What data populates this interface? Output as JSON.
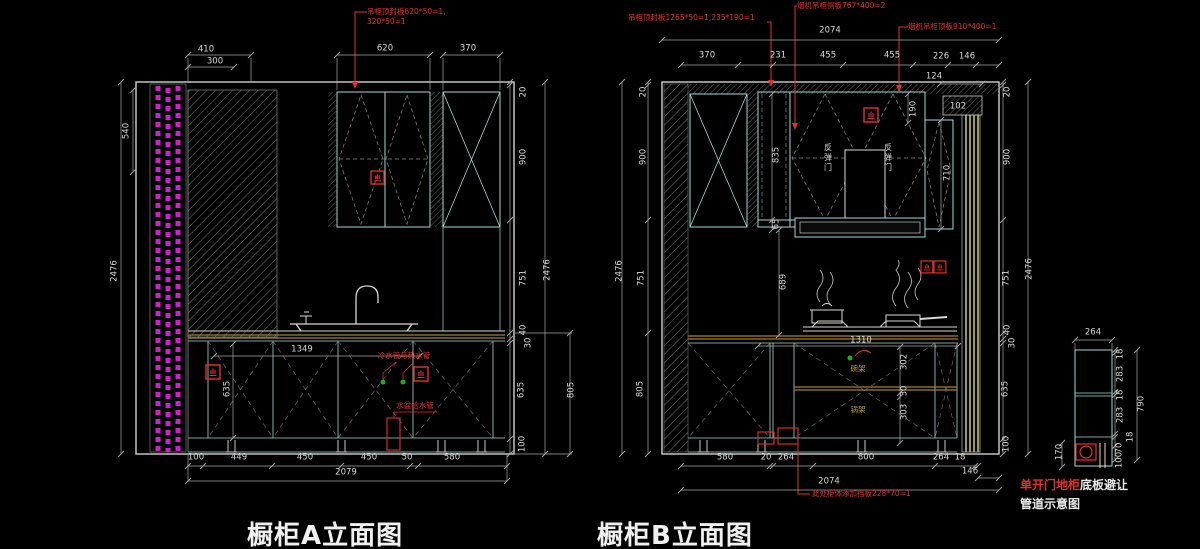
{
  "palette": {
    "background": "#000000",
    "line_white": "#e0e0e0",
    "line_cyan": "#9fd8d8",
    "annotation_red": "#e62e2e",
    "hatch_magenta": "#cf1fcf",
    "counter_yellow": "#a5821e",
    "stripe_yellow": "#cfcf4a",
    "pipe_green": "#16b316"
  },
  "titles": {
    "a": "橱柜A立面图",
    "b": "橱柜B立面图"
  },
  "a": {
    "annotation_top": {
      "line1": "吊柜顶封板620*50=1,",
      "line2": "320*50=1"
    },
    "top_dims": [
      "410",
      "300",
      "620",
      "370"
    ],
    "left_dims": [
      "540",
      "2476"
    ],
    "right_dims": [
      "20",
      "900",
      "751",
      "40",
      "30",
      "635",
      "100",
      "2476",
      "805"
    ],
    "inner_dims": [
      "1349",
      "635"
    ],
    "pipe_labels": {
      "cold_hot": "冷水管与热水管",
      "sink_supply": "水盆给水管"
    },
    "bottom_dims": [
      "100",
      "449",
      "450",
      "450",
      "50",
      "580",
      "2079"
    ]
  },
  "b": {
    "annotations": {
      "top_left": "吊柜顶封板1265*50=1,235*190=1",
      "hood_side": "烟机吊柜侧板767*400=2",
      "hood_top": "烟机吊柜顶板910*400=1",
      "bottom": "此处柜体添加挡板228*70=1"
    },
    "top_overall": "2074",
    "top_dims": [
      "370",
      "231",
      "455",
      "455",
      "226",
      "146",
      "124"
    ],
    "left_dims": [
      "20",
      "900",
      "751",
      "805",
      "2476"
    ],
    "right_dims": [
      "20",
      "900",
      "751",
      "40",
      "30",
      "635",
      "100",
      "2476"
    ],
    "inner_dims": [
      "835",
      "65",
      "190",
      "102",
      "710",
      "689",
      "1310",
      "302",
      "30",
      "303"
    ],
    "labels": {
      "rebound_door": "反弹门",
      "bowl_rack": "碗架",
      "pot_rack": "锅架"
    },
    "bottom_dims": [
      "580",
      "20",
      "264",
      "800",
      "264",
      "18",
      "146",
      "2074"
    ]
  },
  "detail": {
    "top_dim": "264",
    "right_dims": [
      "18",
      "283",
      "18",
      "283",
      "18",
      "70",
      "100",
      "790"
    ],
    "left_dim": "170",
    "caption": {
      "red": "单开门地柜",
      "white": "底板避让",
      "line2": "管道示意图"
    }
  }
}
